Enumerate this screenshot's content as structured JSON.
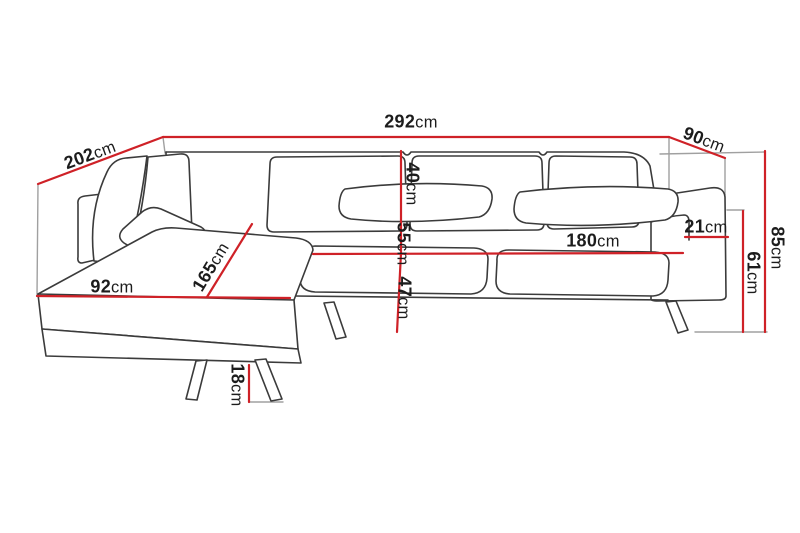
{
  "diagram": {
    "type": "furniture-dimension-diagram",
    "unit": "cm",
    "colors": {
      "dimension_line": "#cf2127",
      "outline": "#3b3b3b",
      "construction_line": "#a0a0a0",
      "text": "#1c1c1c",
      "background": "#ffffff"
    },
    "dimensions": {
      "total_width": {
        "value": "292",
        "unit": "cm"
      },
      "chaise_depth": {
        "value": "202",
        "unit": "cm"
      },
      "end_depth": {
        "value": "90",
        "unit": "cm"
      },
      "overall_height": {
        "value": "85",
        "unit": "cm"
      },
      "armrest_height": {
        "value": "61",
        "unit": "cm"
      },
      "armrest_width": {
        "value": "21",
        "unit": "cm"
      },
      "seat_width": {
        "value": "180",
        "unit": "cm"
      },
      "backrest_height": {
        "value": "40",
        "unit": "cm"
      },
      "seat_depth": {
        "value": "55",
        "unit": "cm"
      },
      "seat_height": {
        "value": "47",
        "unit": "cm"
      },
      "chaise_width": {
        "value": "92",
        "unit": "cm"
      },
      "chaise_length": {
        "value": "165",
        "unit": "cm"
      },
      "leg_height": {
        "value": "18",
        "unit": "cm"
      }
    }
  }
}
